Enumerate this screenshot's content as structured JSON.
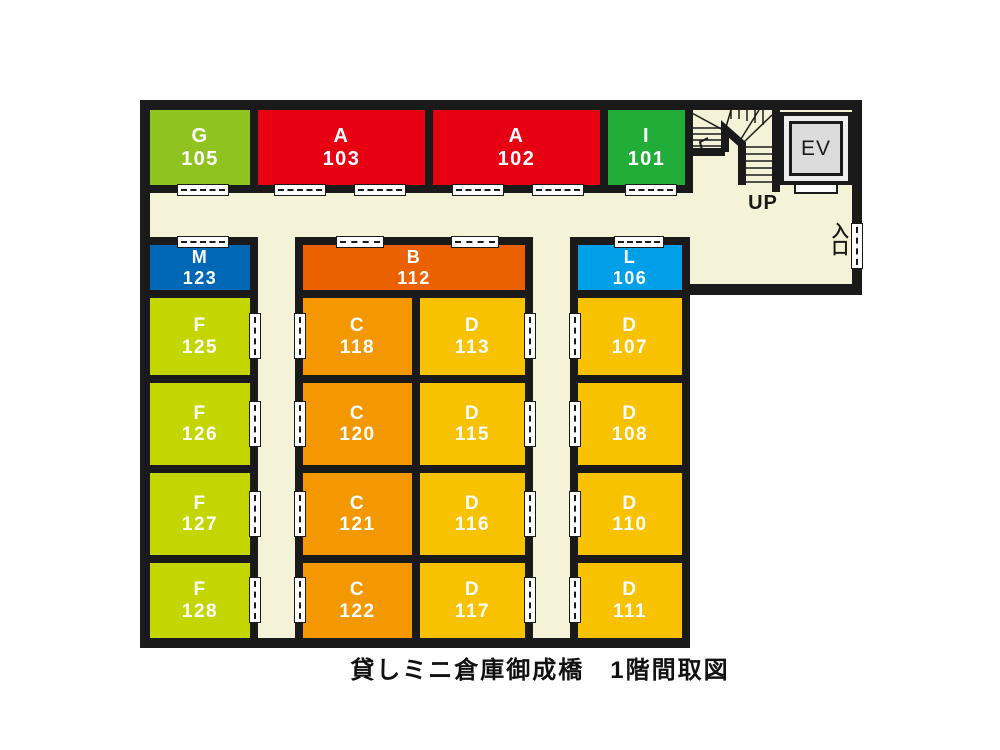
{
  "floor_plan": {
    "caption": "貸しミニ倉庫御成橋　1階間取図",
    "stairs_label": "UP",
    "elevator_label": "EV",
    "entrance_label": "入口",
    "colors": {
      "wall": "#1a1a1a",
      "floor": "#F4F3D8",
      "type_G": "#8FC31F",
      "type_A": "#E60012",
      "type_I": "#22AC38",
      "type_M": "#0068B7",
      "type_B": "#EB6100",
      "type_L": "#00A0E9",
      "type_F": "#C3D600",
      "type_C": "#F39800",
      "type_D": "#F9C200"
    },
    "units": [
      {
        "letter": "G",
        "number": "105",
        "type": "G",
        "x": 142,
        "y": 102,
        "w": 116,
        "h": 91,
        "fs": 20
      },
      {
        "letter": "A",
        "number": "103",
        "type": "A",
        "x": 250,
        "y": 102,
        "w": 183,
        "h": 91,
        "fs": 20
      },
      {
        "letter": "A",
        "number": "102",
        "type": "A",
        "x": 425,
        "y": 102,
        "w": 183,
        "h": 91,
        "fs": 20
      },
      {
        "letter": "I",
        "number": "101",
        "type": "I",
        "x": 600,
        "y": 102,
        "w": 93,
        "h": 91,
        "fs": 20
      },
      {
        "letter": "M",
        "number": "123",
        "type": "M",
        "x": 142,
        "y": 237,
        "w": 116,
        "h": 61,
        "fs": 18
      },
      {
        "letter": "B",
        "number": "112",
        "type": "B",
        "x": 295,
        "y": 237,
        "w": 238,
        "h": 61,
        "fs": 18
      },
      {
        "letter": "L",
        "number": "106",
        "type": "L",
        "x": 570,
        "y": 237,
        "w": 120,
        "h": 61,
        "fs": 18
      },
      {
        "letter": "F",
        "number": "125",
        "type": "F",
        "x": 142,
        "y": 290,
        "w": 116,
        "h": 93,
        "fs": 19
      },
      {
        "letter": "C",
        "number": "118",
        "type": "C",
        "x": 295,
        "y": 290,
        "w": 125,
        "h": 93,
        "fs": 19
      },
      {
        "letter": "D",
        "number": "113",
        "type": "D",
        "x": 412,
        "y": 290,
        "w": 121,
        "h": 93,
        "fs": 19
      },
      {
        "letter": "D",
        "number": "107",
        "type": "D",
        "x": 570,
        "y": 290,
        "w": 120,
        "h": 93,
        "fs": 19
      },
      {
        "letter": "F",
        "number": "126",
        "type": "F",
        "x": 142,
        "y": 375,
        "w": 116,
        "h": 98,
        "fs": 19
      },
      {
        "letter": "C",
        "number": "120",
        "type": "C",
        "x": 295,
        "y": 375,
        "w": 125,
        "h": 98,
        "fs": 19
      },
      {
        "letter": "D",
        "number": "115",
        "type": "D",
        "x": 412,
        "y": 375,
        "w": 121,
        "h": 98,
        "fs": 19
      },
      {
        "letter": "D",
        "number": "108",
        "type": "D",
        "x": 570,
        "y": 375,
        "w": 120,
        "h": 98,
        "fs": 19
      },
      {
        "letter": "F",
        "number": "127",
        "type": "F",
        "x": 142,
        "y": 465,
        "w": 116,
        "h": 98,
        "fs": 19
      },
      {
        "letter": "C",
        "number": "121",
        "type": "C",
        "x": 295,
        "y": 465,
        "w": 125,
        "h": 98,
        "fs": 19
      },
      {
        "letter": "D",
        "number": "116",
        "type": "D",
        "x": 412,
        "y": 465,
        "w": 121,
        "h": 98,
        "fs": 19
      },
      {
        "letter": "D",
        "number": "110",
        "type": "D",
        "x": 570,
        "y": 465,
        "w": 120,
        "h": 98,
        "fs": 19
      },
      {
        "letter": "F",
        "number": "128",
        "type": "F",
        "x": 142,
        "y": 555,
        "w": 116,
        "h": 91,
        "fs": 19
      },
      {
        "letter": "C",
        "number": "122",
        "type": "C",
        "x": 295,
        "y": 555,
        "w": 125,
        "h": 91,
        "fs": 19
      },
      {
        "letter": "D",
        "number": "117",
        "type": "D",
        "x": 412,
        "y": 555,
        "w": 121,
        "h": 91,
        "fs": 19
      },
      {
        "letter": "D",
        "number": "111",
        "type": "D",
        "x": 570,
        "y": 555,
        "w": 120,
        "h": 91,
        "fs": 19
      }
    ],
    "doors": [
      {
        "o": "h",
        "x": 177,
        "y": 184,
        "l": 52
      },
      {
        "o": "h",
        "x": 274,
        "y": 184,
        "l": 52
      },
      {
        "o": "h",
        "x": 354,
        "y": 184,
        "l": 52
      },
      {
        "o": "h",
        "x": 452,
        "y": 184,
        "l": 52
      },
      {
        "o": "h",
        "x": 532,
        "y": 184,
        "l": 52
      },
      {
        "o": "h",
        "x": 625,
        "y": 184,
        "l": 52
      },
      {
        "o": "h",
        "x": 177,
        "y": 236,
        "l": 52
      },
      {
        "o": "h",
        "x": 336,
        "y": 236,
        "l": 48
      },
      {
        "o": "h",
        "x": 451,
        "y": 236,
        "l": 48
      },
      {
        "o": "h",
        "x": 614,
        "y": 236,
        "l": 50
      },
      {
        "o": "v",
        "x": 249,
        "y": 313,
        "l": 46
      },
      {
        "o": "v",
        "x": 249,
        "y": 401,
        "l": 46
      },
      {
        "o": "v",
        "x": 249,
        "y": 491,
        "l": 46
      },
      {
        "o": "v",
        "x": 249,
        "y": 577,
        "l": 46
      },
      {
        "o": "v",
        "x": 294,
        "y": 313,
        "l": 46
      },
      {
        "o": "v",
        "x": 294,
        "y": 401,
        "l": 46
      },
      {
        "o": "v",
        "x": 294,
        "y": 491,
        "l": 46
      },
      {
        "o": "v",
        "x": 294,
        "y": 577,
        "l": 46
      },
      {
        "o": "v",
        "x": 524,
        "y": 313,
        "l": 46
      },
      {
        "o": "v",
        "x": 524,
        "y": 401,
        "l": 46
      },
      {
        "o": "v",
        "x": 524,
        "y": 491,
        "l": 46
      },
      {
        "o": "v",
        "x": 524,
        "y": 577,
        "l": 46
      },
      {
        "o": "v",
        "x": 569,
        "y": 313,
        "l": 46
      },
      {
        "o": "v",
        "x": 569,
        "y": 401,
        "l": 46
      },
      {
        "o": "v",
        "x": 569,
        "y": 491,
        "l": 46
      },
      {
        "o": "v",
        "x": 569,
        "y": 577,
        "l": 46
      },
      {
        "o": "v",
        "x": 851,
        "y": 223,
        "l": 46
      }
    ]
  }
}
